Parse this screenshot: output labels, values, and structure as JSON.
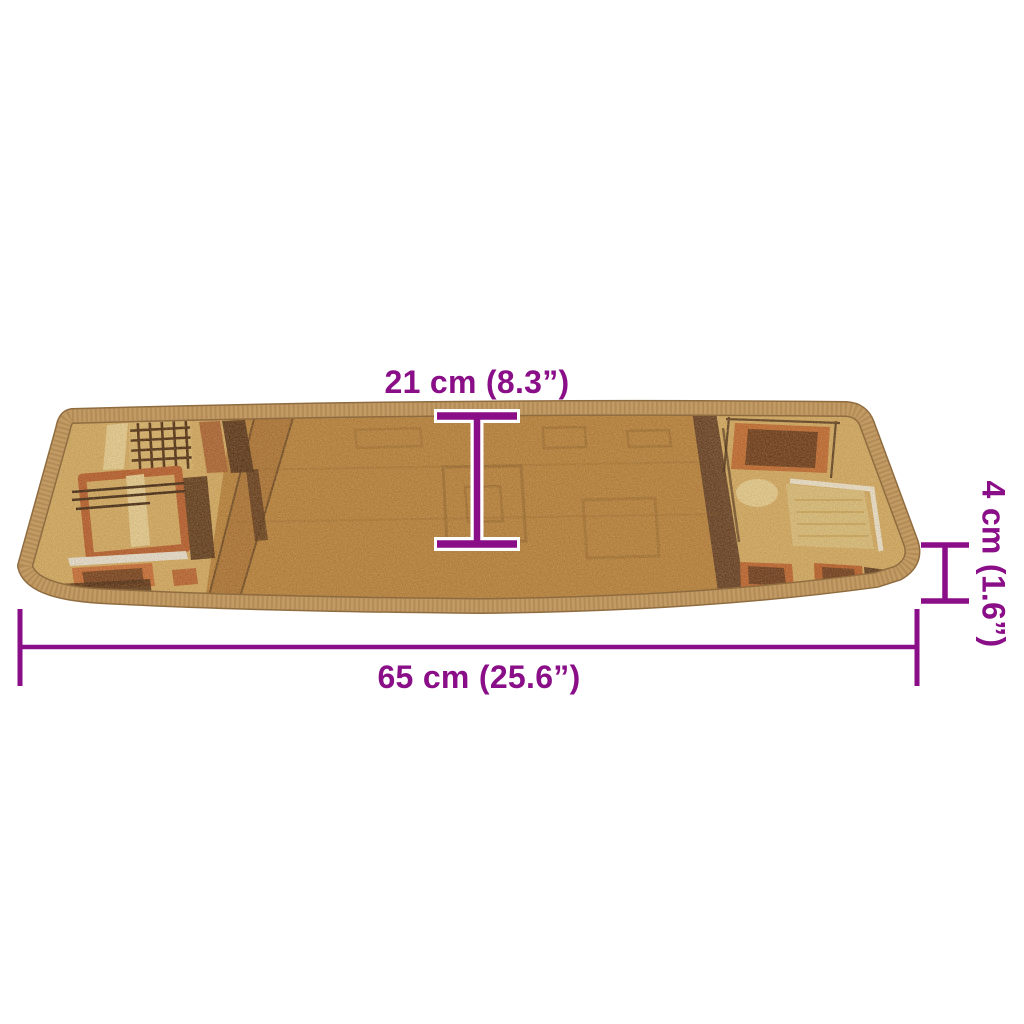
{
  "scene": {
    "background_color": "#ffffff",
    "accent_color": "#8a0e87",
    "illustration": "stair-tread-carpet-perspective"
  },
  "dimensions": {
    "depth_label": "21 cm (8.3”)",
    "thickness_label": "4 cm (1.6”)",
    "width_label": "65 cm (25.6”)"
  },
  "mat": {
    "colors": {
      "serge_border": "#c19a64",
      "center_field": "#b67f3a",
      "end_panels": "#d4ab63",
      "dark_brown": "#4e2b15",
      "rust_orange": "#b5582a",
      "cream": "#e8d096",
      "white_accent": "#e9e5db"
    }
  }
}
